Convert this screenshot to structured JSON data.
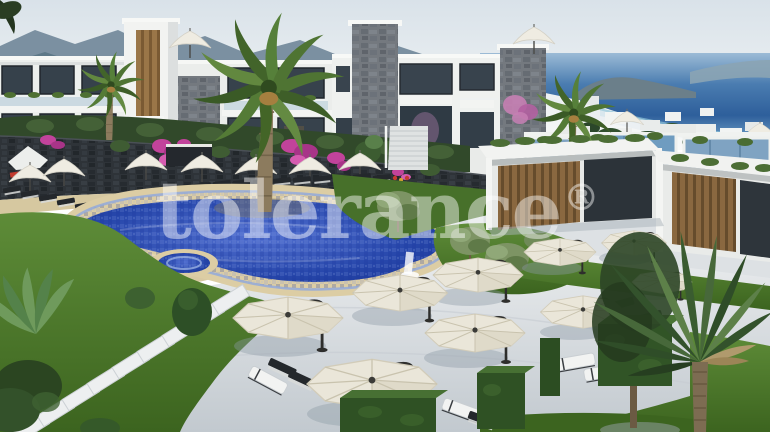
{
  "watermark": {
    "text": "tolerance",
    "registered": "®"
  },
  "palette": {
    "sky": "#dce4ea",
    "mountains_far": "#7b90a1",
    "mountains_near": "#5d7888",
    "sea": "#3a6ea8",
    "sea_shallow": "#8fc3d8",
    "building_white": "#eff1ef",
    "window_glass": "#37424c",
    "stone_cladding": "#74797f",
    "stone_wall_dark": "#2e3338",
    "wood_accent": "#8a6840",
    "pool_water": "#2747ab",
    "pool_coping": "#dccda4",
    "grass": "#4b7a2c",
    "paving": "#dfe3e6",
    "umbrella_canopy_cream": "#eae6d9",
    "umbrella_canopy_white": "#efece2",
    "umbrella_frame": "#2e2e2c",
    "lounger_dark": "#24282c",
    "bougainvillea": "#c2439b",
    "hedge": "#2f5124",
    "watermark_color": "#ffffff"
  }
}
